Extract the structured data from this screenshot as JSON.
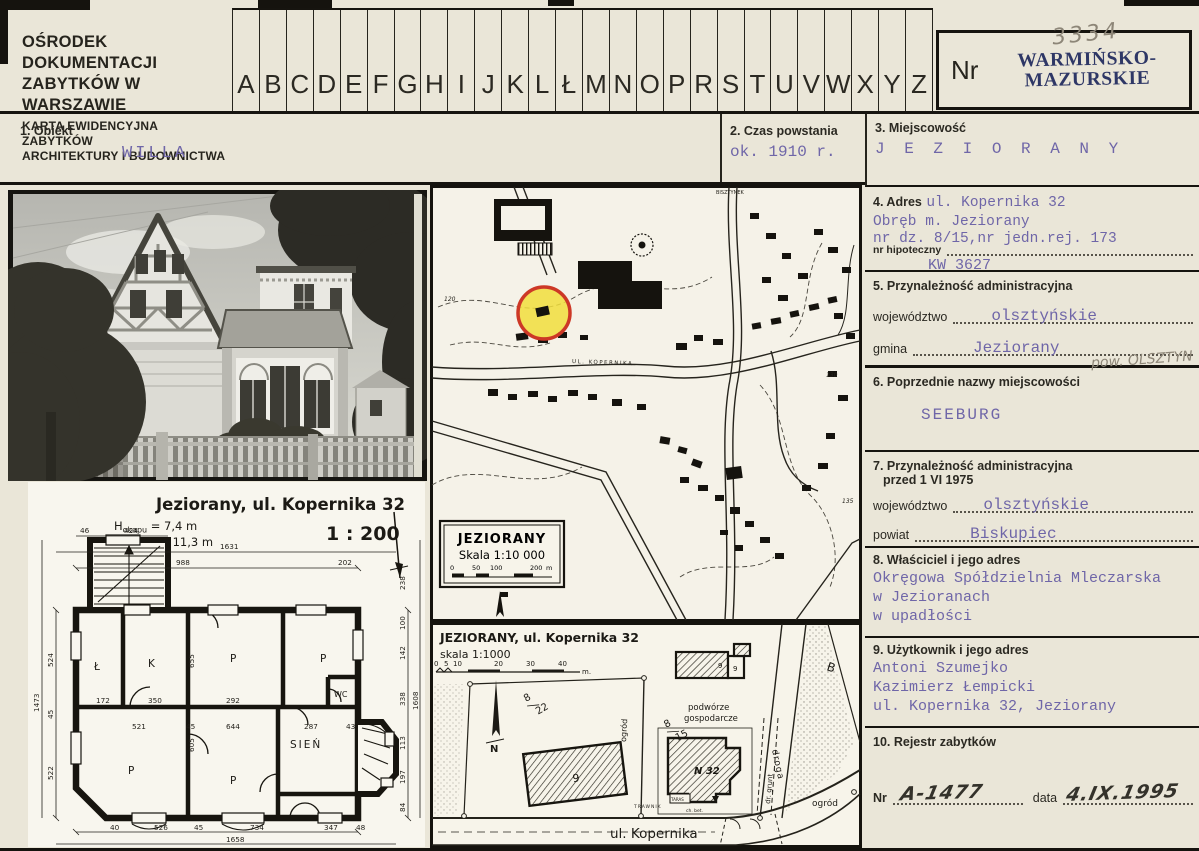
{
  "colors": {
    "paper": "#eae6d8",
    "typewriter_purple": "#6f66a8",
    "stamp_navy": "#2e3766",
    "pencil_gray": "#8d8678",
    "ink": "#34322b",
    "marker_yellow": "#f1de3c",
    "marker_red": "#cd3826"
  },
  "header": {
    "org_line1": "OŚRODEK DOKUMENTACJI",
    "org_line2": "ZABYTKÓW W WARSZAWIE",
    "card_line1": "KARTA EWIDENCYJNA ZABYTKÓW",
    "card_line2": "ARCHITEKTURY I BUDOWNICTWA",
    "alphabet": [
      "A",
      "B",
      "C",
      "D",
      "E",
      "F",
      "G",
      "H",
      "I",
      "J",
      "K",
      "L",
      "Ł",
      "M",
      "N",
      "O",
      "P",
      "R",
      "S",
      "T",
      "U",
      "V",
      "W",
      "X",
      "Y",
      "Z"
    ],
    "nr_label": "Nr",
    "region_stamp_line1": "WARMIŃSKO-",
    "region_stamp_line2": "MAZURSKIE",
    "inventory_number": "3334"
  },
  "fields": {
    "f1": {
      "label": "1. Obiekt",
      "value": "WILLA"
    },
    "f2": {
      "label": "2. Czas powstania",
      "value": "ok. 1910 r."
    },
    "f3": {
      "label": "3. Miejscowość",
      "value": "J E Z I O R A N Y"
    },
    "f4": {
      "label": "4. Adres",
      "value": "ul. Kopernika 32",
      "line2": "Obręb m. Jeziorany",
      "line3": "nr dz. 8/15,nr jedn.rej. 173",
      "sub_label": "nr hipoteczny",
      "sub_value": "KW 3627"
    },
    "f5": {
      "label": "5. Przynależność administracyjna",
      "row1_label": "województwo",
      "row1_value": "olsztyńskie",
      "row2_label": "gmina",
      "row2_value": "Jeziorany",
      "annotation": "pow. OLSZTYN"
    },
    "f6": {
      "label": "6. Poprzednie nazwy miejscowości",
      "value": "SEEBURG"
    },
    "f7": {
      "label": "7. Przynależność administracyjna",
      "label2": "przed 1 VI 1975",
      "row1_label": "województwo",
      "row1_value": "olsztyńskie",
      "row2_label": "powiat",
      "row2_value": "Biskupiec"
    },
    "f8": {
      "label": "8. Właściciel i jego adres",
      "line1": "Okręgowa Spółdzielnia Mleczarska",
      "line2": "w Jezioranach",
      "line3": "w upadłości"
    },
    "f9": {
      "label": "9. Użytkownik i jego adres",
      "line1": "Antoni Szumejko",
      "line2": "Kazimierz Łempicki",
      "line3": "ul. Kopernika 32, Jeziorany"
    },
    "f10": {
      "label": "10. Rejestr zabytków",
      "nr_label": "Nr",
      "nr_value": "A-1477",
      "date_label": "data",
      "date_value": "4.IX.1995"
    }
  },
  "map": {
    "legend_title": "JEZIORANY",
    "legend_scale": "Skala 1:10 000",
    "scale_ticks": [
      "0",
      "50",
      "100",
      "200"
    ],
    "scale_unit": "m",
    "street_label": "UL. KOPERNIKA",
    "top_street_label": "BISZTYNEK",
    "contour_labels": [
      "120",
      "130",
      "135"
    ]
  },
  "floor_plan": {
    "title": "Jeziorany, ul. Kopernika 32",
    "h1_sym": "H",
    "h1_sub": "okapu",
    "h1_val": " =  7,4 m",
    "h2_sym": "H",
    "h2_sub": "kalenicy",
    "h2_val": " = 11,3 m",
    "scale": "1 : 200",
    "rooms": {
      "lazienka": "Ł",
      "kuchnia": "K",
      "p1": "P",
      "p2": "P",
      "p3": "P",
      "p4": "P",
      "wc": "WC",
      "sien": "SIEŃ"
    },
    "dims": [
      "1631",
      "988",
      "202",
      "424",
      "46",
      "1473",
      "524",
      "522",
      "45",
      "40",
      "526",
      "45",
      "734",
      "347",
      "48",
      "1658",
      "238",
      "100",
      "142",
      "338",
      "113",
      "197",
      "84",
      "1608",
      "172",
      "350",
      "292",
      "655",
      "605",
      "521",
      "45",
      "644",
      "287",
      "43"
    ]
  },
  "site_plan": {
    "title": "JEZIORANY, ul. Kopernika 32",
    "scale": "skala 1:1000",
    "scale_ticks": [
      "0",
      "5",
      "10",
      "20",
      "30",
      "40"
    ],
    "scale_unit": "m.",
    "north_label": "N",
    "labels": {
      "yard_line1": "podwórze",
      "yard_line2": "gospodarcze",
      "plot_a_num": "8",
      "plot_a_den": "15",
      "plot_b_num": "8",
      "plot_b_den": "22",
      "area_b": "B",
      "building_main": "N 32",
      "building_left": "9",
      "farm_mark_a": "9",
      "farm_mark_b": "9",
      "terrace": "TARAS",
      "pavement": "ch. bet.",
      "lawn": "TRAWNIK",
      "garden_right": "ogród",
      "garden_mid": "ogród",
      "road": "droga",
      "dirt_road": "dr. grunt",
      "street": "ul. Kopernika"
    }
  }
}
